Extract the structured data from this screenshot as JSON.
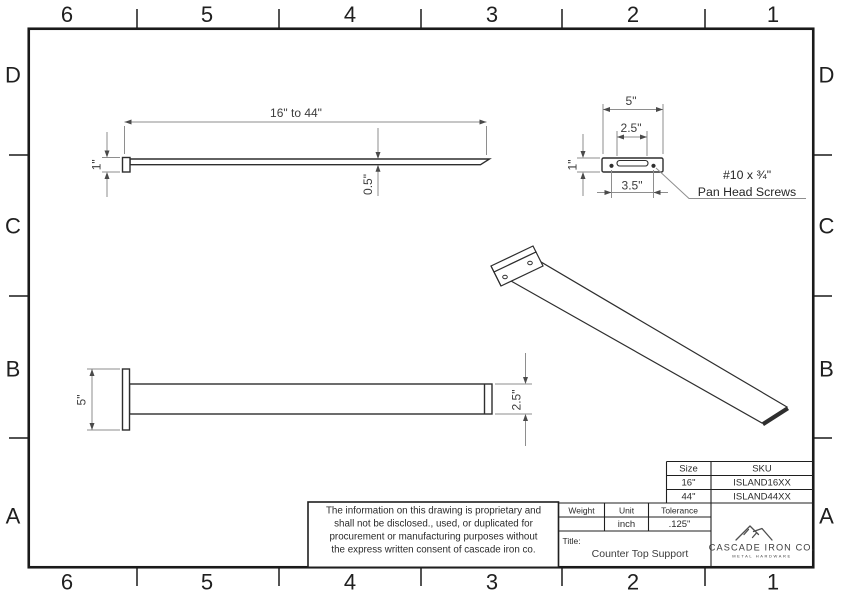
{
  "colors": {
    "line": "#2e2e2e",
    "dimension": "#8e8e8e",
    "text": "#2a2a2a",
    "logo_gray": "#6f6f6f"
  },
  "border": {
    "columns": [
      "6",
      "5",
      "4",
      "3",
      "2",
      "1"
    ],
    "rows": [
      "D",
      "C",
      "B",
      "A"
    ]
  },
  "views": {
    "side_view": {
      "length_dim": "16\" to 44\"",
      "plate_height_dim": "1\"",
      "thickness_dim": "0.5\""
    },
    "plate_detail": {
      "plate_width_dim": "5\"",
      "slot_width_dim": "2.5\"",
      "plate_height_dim": "1\"",
      "hole_spacing_dim": "3.5\"",
      "screw_note_line1": "#10 x ¾\"",
      "screw_note_line2": "Pan Head Screws"
    },
    "top_view": {
      "plate_width_dim": "5\"",
      "bar_width_dim": "2.5\""
    }
  },
  "title_block": {
    "disclaimer_lines": [
      "The information on this drawing is proprietary and",
      "shall not be disclosed., used, or duplicated for",
      "procurement or manufacturing purposes without",
      "the express written consent of cascade iron co."
    ],
    "size_table": {
      "col1_header": "Size",
      "col2_header": "SKU",
      "rows": [
        {
          "size": "16\"",
          "sku": "ISLAND16XX"
        },
        {
          "size": "44\"",
          "sku": "ISLAND44XX"
        }
      ]
    },
    "spec_table": {
      "weight_header": "Weight",
      "unit_header": "Unit",
      "tolerance_header": "Tolerance",
      "weight_value": "",
      "unit_value": "inch",
      "tolerance_value": ".125\""
    },
    "title_label": "Title:",
    "title_value": "Counter Top Support",
    "logo": {
      "company": "CASCADE IRON CO.",
      "tagline": "METAL HARDWARE"
    }
  }
}
